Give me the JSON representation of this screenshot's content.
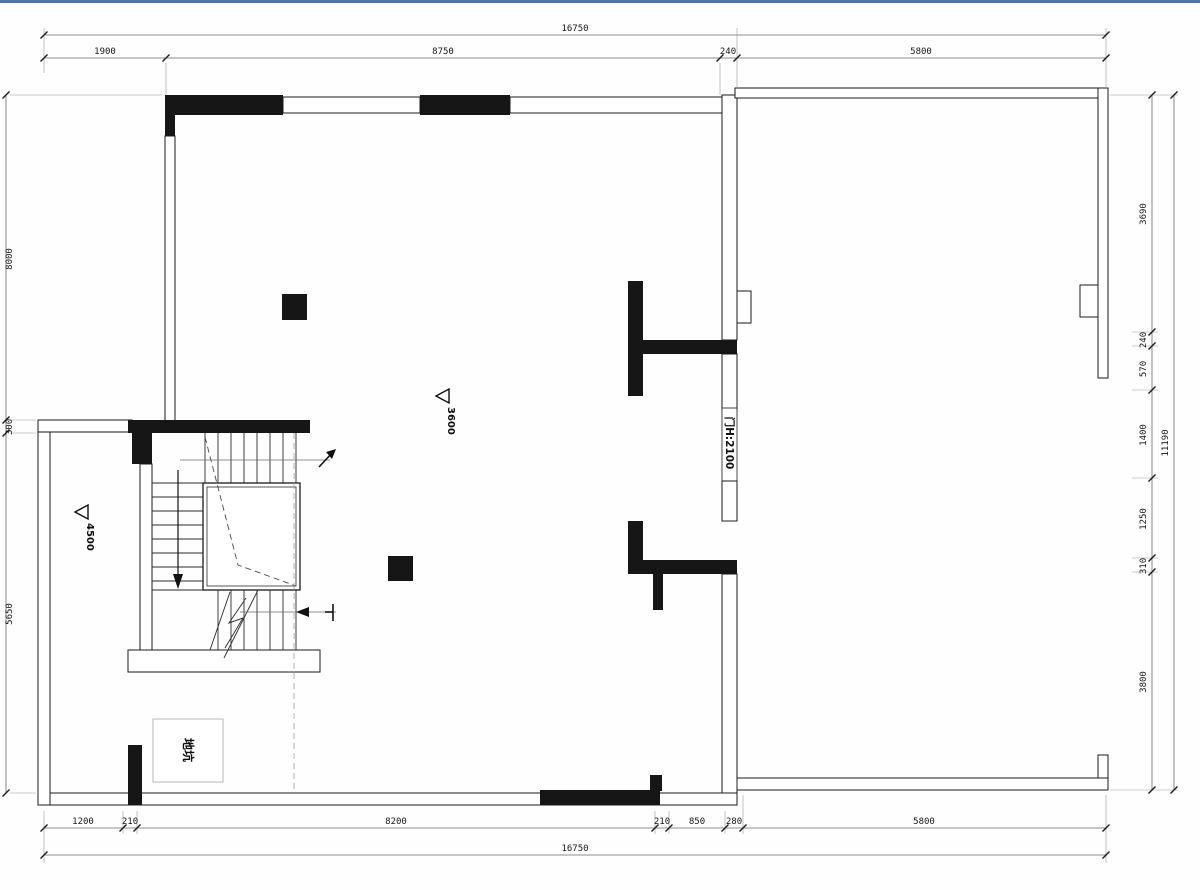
{
  "meta": {
    "drawing_type": "basement floor plan (CAD)",
    "colors": {
      "accent_top_line": "#4a72b8",
      "wall_fill": "#161616",
      "dimension_line": "#6a6a6a",
      "background": "#fefefe",
      "pit_box_border": "#b5b5b5"
    },
    "icons": {
      "elevation_marker": "left-pointing-triangle-flag",
      "stair_direction": "down-arrow",
      "section_cut_upper": "ne-arrow",
      "section_cut_lower": "left-arrow-with-tick"
    }
  },
  "labels": {
    "pit": "地坑",
    "door_height": "门H:2100",
    "level_hall": "3600",
    "level_annex": "4500"
  },
  "dims": {
    "top_overall": "16750",
    "top": [
      "1900",
      "8750",
      "240",
      "5800"
    ],
    "bottom": [
      "1200",
      "210",
      "8200",
      "210",
      "850",
      "280",
      "5800"
    ],
    "bottom_overall": "16750",
    "left": [
      "8000",
      "300",
      "5650"
    ],
    "right": [
      "3690",
      "240",
      "570",
      "1400",
      "1250",
      "310",
      "3800"
    ],
    "right_overall": "11190"
  }
}
